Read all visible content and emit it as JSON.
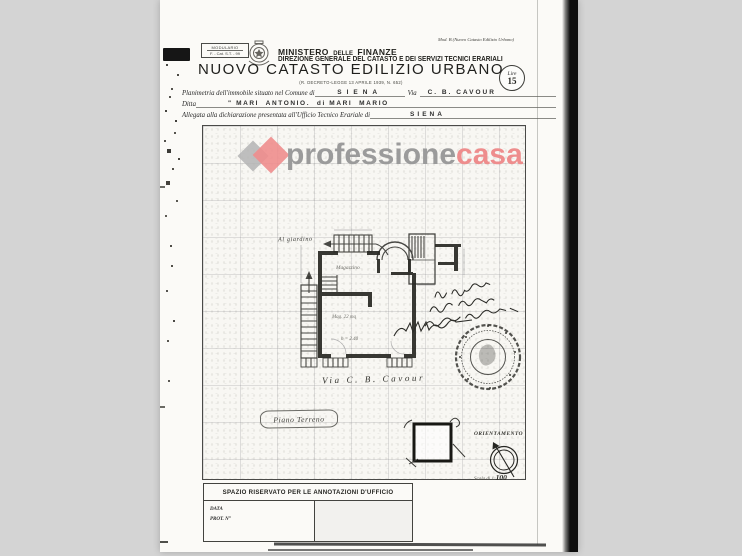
{
  "colors": {
    "background": "#d4d4d4",
    "paper": "#fbfaf7",
    "ink": "#1f1f1f",
    "watermark_gray": "#9b9b9b",
    "watermark_red": "#ee8d8d",
    "scan_band": "#0d0d0d"
  },
  "stamp_modulario": {
    "line1": "MODULARIO",
    "line2": "F. - Cat. S.T. - 99"
  },
  "header": {
    "ministry_word1": "MINISTERO",
    "ministry_word2": "DELLE",
    "ministry_word3": "FINANZE",
    "direction": "DIREZIONE GENERALE DEL CATASTO E DEI SERVIZI TECNICI ERARIALI",
    "mod_ref": "Mod. B (Nuovo Catasto Edilizio Urbano)",
    "lire_label": "Lire",
    "lire_value": "15",
    "title": "NUOVO CATASTO EDILIZIO URBANO",
    "subtitle": "(R. DECRETO-LEGGE 13 APRILE 1939, N. 652)"
  },
  "form": {
    "comune_label": "Planimetria dell'immobile situato nel Comune di",
    "comune_value": "SIENA",
    "via_label": "Via",
    "via_value": "C. B. CAVOUR",
    "ditta_label": "Ditta",
    "ditta_value": "\" MARI  ANTONIO.  di MARI  MARIO",
    "ufficio_label": "Allegata alla dichiarazione presentata all'Ufficio Tecnico Erariale di",
    "ufficio_value": "SIENA"
  },
  "watermark": {
    "word_gray": "professione",
    "word_red": "casa"
  },
  "plan": {
    "al_giardino": "Al giardino",
    "room1": "Magazzino",
    "room2_area": "Mag. 22 mq",
    "room2_height": "h = 2.40",
    "street": "Via C. B. Cavour",
    "floor_label": "Piano Terreno",
    "orientation_label": "ORIENTAMENTO",
    "scale_prefix": "Scala di 1:",
    "scale_value": "100"
  },
  "footer": {
    "annotations_title": "SPAZIO RISERVATO PER LE ANNOTAZIONI D'UFFICIO",
    "data_label": "DATA",
    "prot_label": "PROT. N°"
  }
}
